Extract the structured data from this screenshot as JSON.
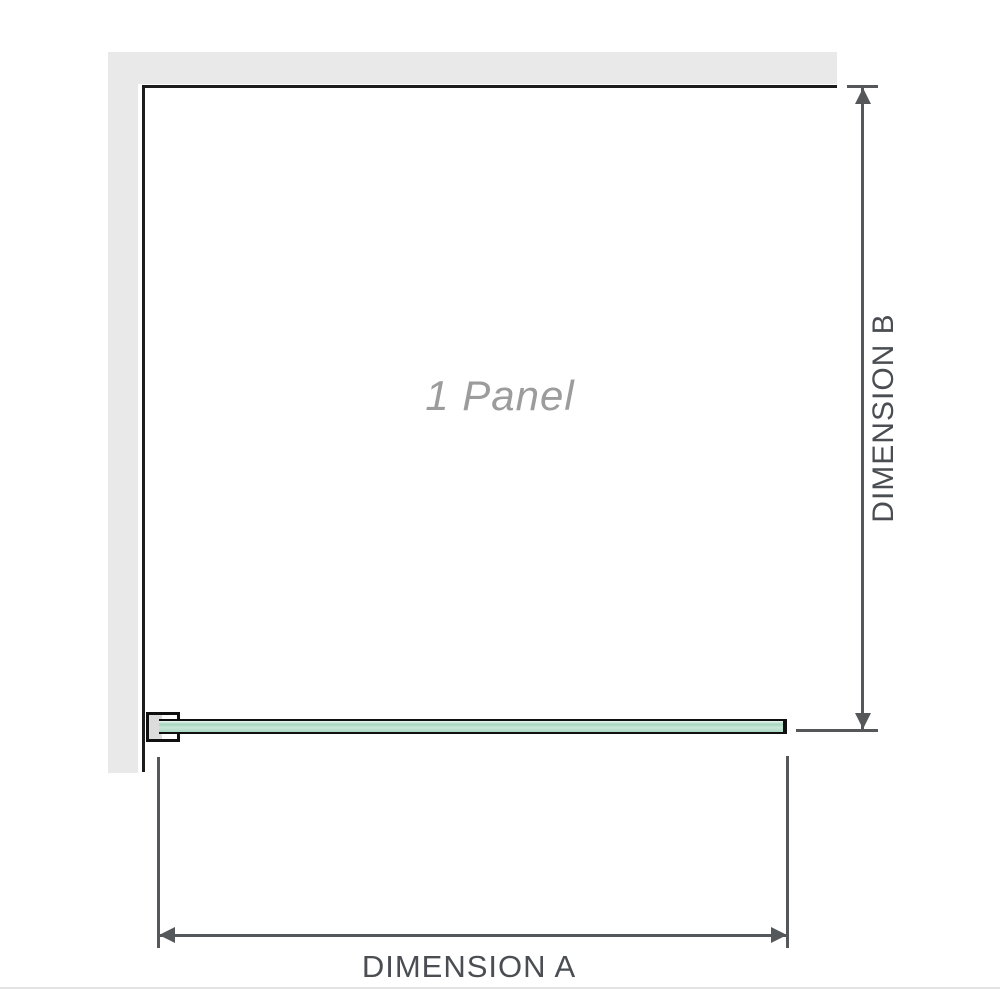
{
  "diagram": {
    "panel_label": "1 Panel",
    "dimension_a_label": "DIMENSION A",
    "dimension_b_label": "DIMENSION B"
  },
  "colors": {
    "wall": "#e9e9e9",
    "panel_border": "#1c1c1c",
    "glass_border": "#101010",
    "glass_fill": "#a6d7bf",
    "bracket_fill": "#dcdcdc",
    "dimension_line": "#55585a",
    "dimension_text": "#4a4e52",
    "panel_label": "#9c9c9c",
    "baseline_rule": "#e4e4e4"
  }
}
